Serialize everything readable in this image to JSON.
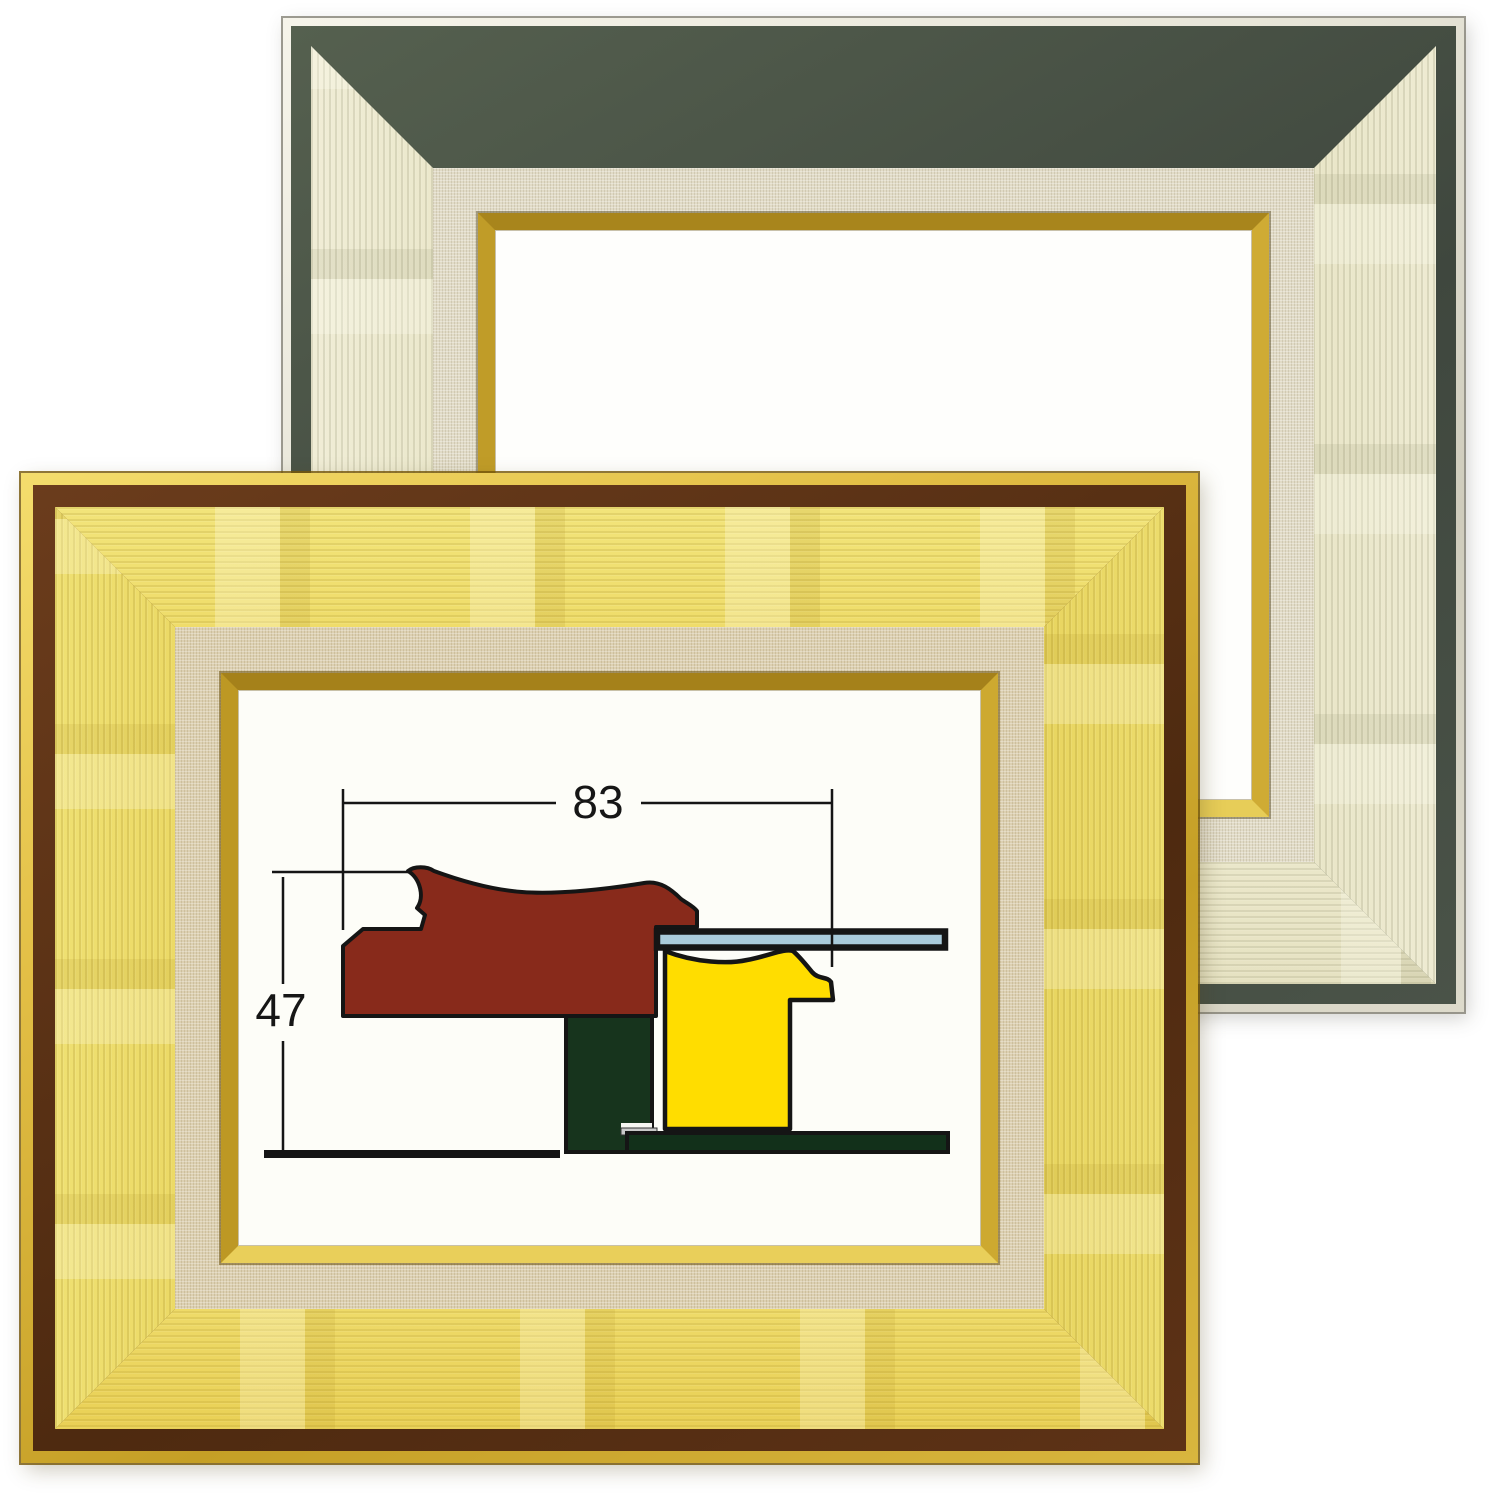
{
  "scene": {
    "description": "Product photo: two empty oil-painting picture frames with linen liners - a gold frame in front (lower left) and a champagne-silver frame behind (upper right). Inside the gold frame a cross-section diagram of the moulding is shown with its dimensions.",
    "background_color": "#ffffff"
  },
  "silver_frame": {
    "finish": "champagne-silver",
    "outer_edge_color": "#e9e6d8",
    "accent_band_color": "#47504a",
    "moulding_color": "#d8d2a8",
    "linen_liner_color": "#e1dbc7",
    "fillet_color": "#c9a53a"
  },
  "gold_frame": {
    "finish": "brushed-gold",
    "outer_edge_color": "#d9b63e",
    "accent_band_color": "#5d3216",
    "moulding_color": "#e4cc48",
    "linen_liner_color": "#dcd0b2",
    "fillet_color": "#caa52e"
  },
  "diagram": {
    "width_label": "83",
    "height_label": "47",
    "line_color": "#151515",
    "parts": {
      "moulding_profile_color": "#882a1b",
      "liner_profile_color": "#ffdd00",
      "glass_color": "#a9cbdb",
      "stretcher_bar_color": "#17341d",
      "backing_board_color": "#12301a",
      "shim_color": "#c9c9c9"
    }
  }
}
